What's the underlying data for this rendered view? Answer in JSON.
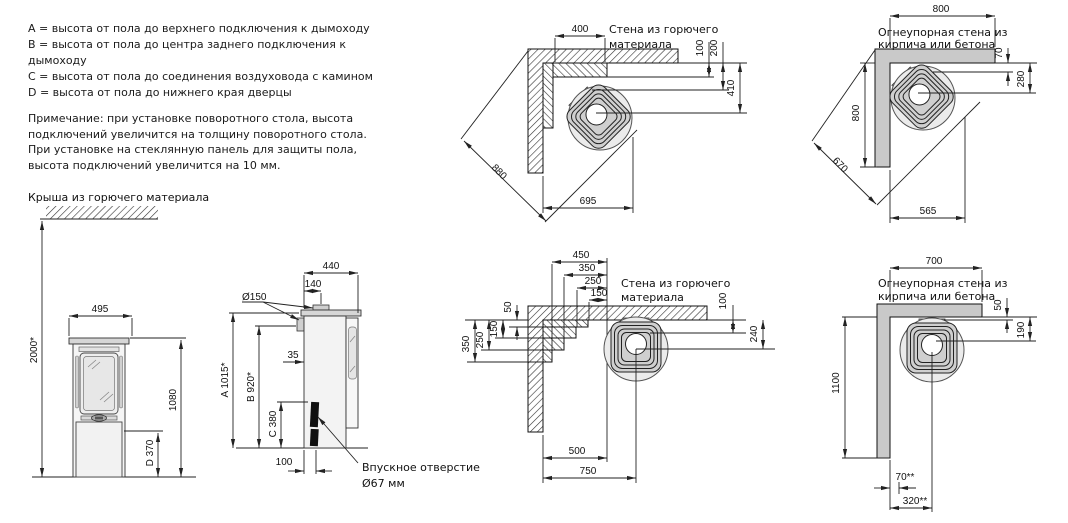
{
  "colors": {
    "line": "#222222",
    "text": "#1a1a1a",
    "fireproof_wall_gray": "#c9c9c9",
    "stove_body_gray": "#ebebeb",
    "stove_plate_gray": "#d6d6d6"
  },
  "legend": {
    "items": [
      "A = высота от пола до верхнего подключения к дымоходу",
      "B = высота от пола до центра заднего подключения к дымоходу",
      "C = высота от пола до соединения воздуховода с камином",
      "D = высота от пола до нижнего края дверцы"
    ],
    "note": "Примечание: при установке поворотного стола, высота подключений увеличится на толщину поворотного стола.  При установке на стеклянную панель для защиты пола, высота подключений увеличится на 10 мм.",
    "roof_label": "Крыша из горючего материала"
  },
  "front_view": {
    "width": "495",
    "total_height": "2000*",
    "height": "1080",
    "door_height": "D 370"
  },
  "side_view": {
    "depth": "440",
    "flue_offset": "140",
    "flue_diameter": "Ø150",
    "rear_offset": "35",
    "dim_a": "A 1015*",
    "dim_b": "B 920*",
    "dim_c": "C 380",
    "inlet_offset": "100",
    "inlet_label_line1": "Впускное отверстие",
    "inlet_label_line2": "Ø67 мм"
  },
  "corner_top_combustible": {
    "wall_label_line1": "Стена из горючего",
    "wall_label_line2": "материала",
    "top": "400",
    "gap1": "100",
    "gap2": "200",
    "to_center": "410",
    "diagonal": "880",
    "bottom": "695"
  },
  "corner_top_fireproof": {
    "wall_label_line1": "Огнеупорная стена из",
    "wall_label_line2": "кирпича или бетона",
    "top": "800",
    "gap1": "70",
    "to_center": "280",
    "left": "800",
    "diagonal": "670",
    "bottom": "565"
  },
  "corner_bottom_combustible": {
    "wall_label_line1": "Стена из горючего",
    "wall_label_line2": "материала",
    "top_dims": [
      "450",
      "350",
      "250",
      "150"
    ],
    "left_dims": [
      "50",
      "150",
      "250",
      "350"
    ],
    "gap": "100",
    "to_center": "240",
    "bottom_front": "500",
    "bottom_center": "750"
  },
  "corner_bottom_fireproof": {
    "wall_label_line1": "Огнеупорная стена из",
    "wall_label_line2": "кирпича или бетона",
    "top": "700",
    "gap": "50",
    "to_center": "190",
    "left": "1100",
    "bottom_offset": "70**",
    "bottom_center": "320**"
  }
}
